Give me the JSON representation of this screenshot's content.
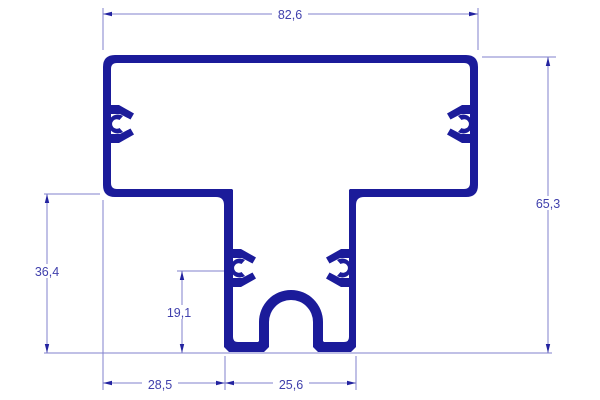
{
  "drawing": {
    "title": "extrusion-profile-cross-section",
    "colors": {
      "background": "#ffffff",
      "profile": "#1b1b9a",
      "dimension_line": "#8282cd",
      "arrow": "#2323a0",
      "text": "#4040ac"
    },
    "dimensions": {
      "top_width": "82,6",
      "overall_height": "65,3",
      "left_height": "36,4",
      "inner_height": "19,1",
      "bottom_left_offset": "28,5",
      "stem_width": "25,6"
    }
  }
}
